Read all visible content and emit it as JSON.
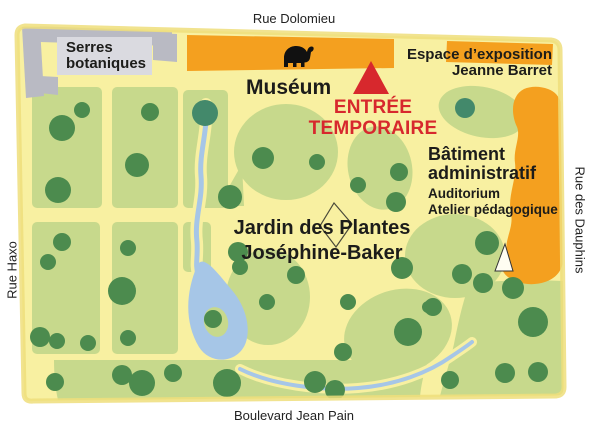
{
  "streets": {
    "top": "Rue Dolomieu",
    "left": "Rue  Haxo",
    "right": "Rue des Dauphins",
    "bottom": "Boulevard Jean Pain"
  },
  "buildings": {
    "serres": {
      "line1": "Serres",
      "line2": "botaniques"
    },
    "museum": {
      "label": "Muséum"
    },
    "espace": {
      "line1": "Espace d’exposition",
      "line2": "Jeanne Barret"
    },
    "batiment": {
      "line1": "Bâtiment",
      "line2": "administratif",
      "sub1": "Auditorium",
      "sub2": "Atelier pédagogique"
    }
  },
  "entrance": {
    "line1": "ENTRÉE",
    "line2": "TEMPORAIRE"
  },
  "park": {
    "line1": "Jardin des Plantes",
    "line2": "Joséphine-Baker"
  },
  "icons": {
    "museum_icon": "elephant-icon",
    "entrance_icon": "entrance-triangle-icon",
    "center_icon": "monument-kite-icon",
    "admin_icon": "tent-icon"
  },
  "colors": {
    "map_bg": "#f8f0a1",
    "map_edge": "#eede7b",
    "lawn": "#c7d98c",
    "tree": "#4c8b4e",
    "tree_alt": "#43896b",
    "water": "#a6c6e7",
    "orange": "#f4a01f",
    "gray": "#b9bac3",
    "panel": "#dadae0",
    "red": "#d7282d",
    "ink": "#1c1c1a",
    "white": "#ffffff"
  }
}
